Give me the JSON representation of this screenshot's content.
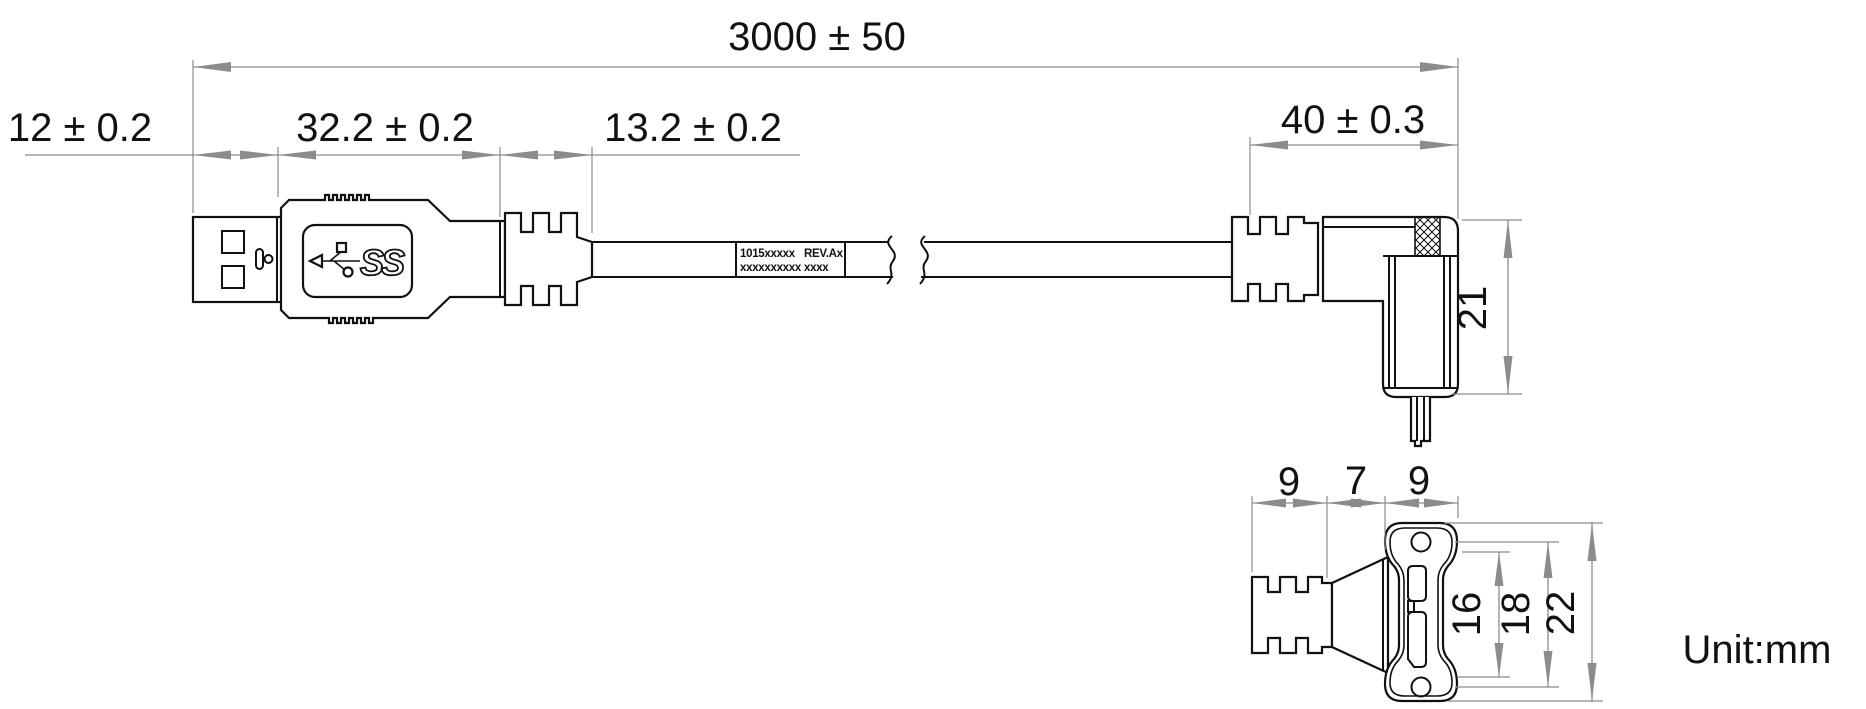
{
  "drawing": {
    "unit_note": "Unit:mm",
    "usb_logo_text": "SS",
    "dimensions": {
      "overall_length": "3000 ± 50",
      "plug_shell_length": "12 ± 0.2",
      "plug_body_length": "32.2 ± 0.2",
      "plug_boot_length": "13.2 ± 0.2",
      "angle_connector_length": "40 ± 0.3",
      "angle_connector_height": "21",
      "boot_width": "9",
      "neck_width": "7",
      "flange_width": "9",
      "hole_inner_span": "16",
      "hole_pitch": "18",
      "flange_height": "22"
    },
    "cable_label": {
      "line1_left": "1015xxxxx",
      "line1_right": "REV.Ax",
      "line2_left": "xxxxxxxxxx",
      "line2_right": "xxxx"
    },
    "colors": {
      "part_line": "#111111",
      "dimension_line": "#8c8c8c",
      "background": "#ffffff"
    }
  }
}
